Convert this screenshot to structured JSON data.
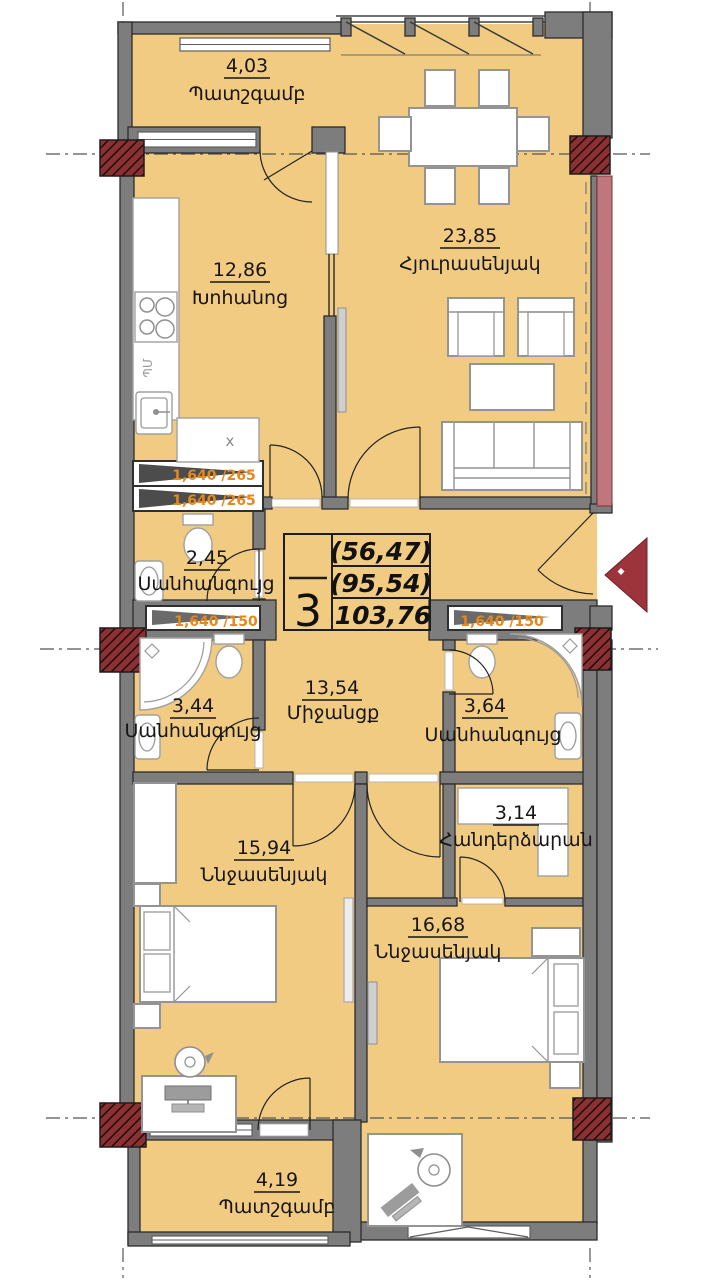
{
  "title": "apartment-floor-plan",
  "unit_info": {
    "rooms_count": "3",
    "area_1": "(56,47)",
    "area_2": "(95,54)",
    "area_3": "103,76"
  },
  "rooms": {
    "balcony_top": {
      "area": "4,03",
      "name": "Պատշգամբ"
    },
    "living": {
      "area": "23,85",
      "name": "Հյուրասենյակ"
    },
    "kitchen": {
      "area": "12,86",
      "name": "Խոհանոց"
    },
    "wc": {
      "area": "2,45",
      "name": "Սանհանգույց"
    },
    "bath_left": {
      "area": "3,44",
      "name": "Սանհանգույց"
    },
    "corridor": {
      "area": "13,54",
      "name": "Միջանցք"
    },
    "bath_right": {
      "area": "3,64",
      "name": "Սանհանգույց"
    },
    "dressing": {
      "area": "3,14",
      "name": "Հանդերձարան"
    },
    "bedroom_left": {
      "area": "15,94",
      "name": "Ննջասենյակ"
    },
    "bedroom_right": {
      "area": "16,68",
      "name": "Ննջասենյակ"
    },
    "balcony_bottom": {
      "area": "4,19",
      "name": "Պատշգամբ"
    }
  },
  "ducts": {
    "kitchen_1": "1,640 /265",
    "kitchen_2": "1,640 /265",
    "bath_left": "1,640 /150",
    "bath_right": "1,640 /150"
  },
  "kitchen_marks": {
    "appliance": "ՊՄ",
    "counter": "x"
  },
  "colors": {
    "floor": "#f2cb82",
    "wall": "#7d7d7d",
    "column_hatch": "#8a3134",
    "party_wall_pink": "#c0767d",
    "duct_label_orange": "#e8871a",
    "entrance_arrow": "#9e343b"
  }
}
